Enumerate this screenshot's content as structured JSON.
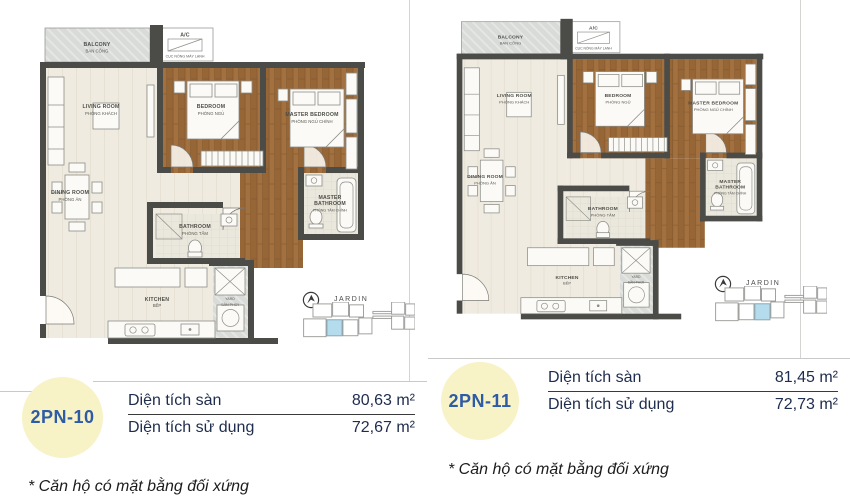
{
  "colors": {
    "wall": "#4b4b48",
    "wood": "#a2713f",
    "floor_beige": "#efebe0",
    "balcony_gray": "#d9dbd8",
    "badge_bg": "#f8f2c7",
    "badge_text": "#2e5ba6",
    "table_text": "#1e2c4d",
    "keyplan_highlight": "#b4dcec"
  },
  "plan_labels": {
    "balcony_en": "BALCONY",
    "balcony_vn": "BAN CÔNG",
    "ac": "A/C",
    "ac_vn": "CỤC NÓNG MÁY LẠNH",
    "living_en": "LIVING ROOM",
    "living_vn": "PHÒNG KHÁCH",
    "bedroom_en": "BEDROOM",
    "bedroom_vn": "PHÒNG NGỦ",
    "master_en": "MASTER BEDROOM",
    "master_vn": "PHÒNG NGỦ CHÍNH",
    "dining_en": "DINING ROOM",
    "dining_vn": "PHÒNG ĂN",
    "bath_en": "BATHROOM",
    "bath_vn": "PHÒNG TẮM",
    "mbath_en1": "MASTER",
    "mbath_en2": "BATHROOM",
    "mbath_vn": "PHÒNG TẮM CHÍNH",
    "kitchen_en": "KITCHEN",
    "kitchen_vn": "BẾP",
    "yard_en": "YARD",
    "yard_vn": "SÂN PHƠI",
    "keyplan": "JARDIN"
  },
  "units": [
    {
      "code": "2PN-10",
      "specs": [
        {
          "label": "Diện tích sàn",
          "value": "80,63 m²"
        },
        {
          "label": "Diện tích sử dụng",
          "value": "72,67 m²"
        }
      ],
      "note": "* Căn hộ có mặt bằng đối xứng"
    },
    {
      "code": "2PN-11",
      "specs": [
        {
          "label": "Diện tích sàn",
          "value": "81,45 m²"
        },
        {
          "label": "Diện tích sử dụng",
          "value": "72,73 m²"
        }
      ],
      "note": "* Căn hộ có mặt bằng đối xứng"
    }
  ]
}
